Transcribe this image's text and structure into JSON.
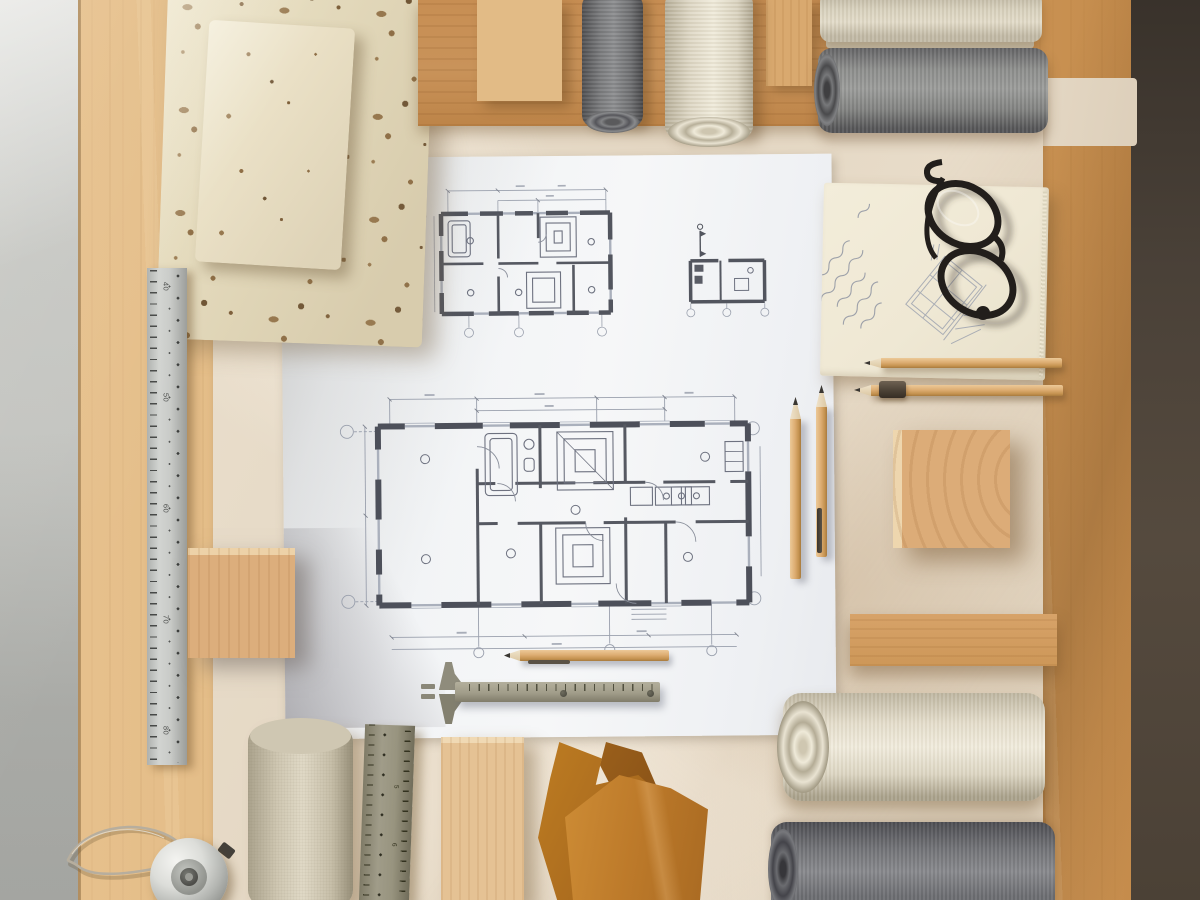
{
  "scene": {
    "type": "photograph",
    "subject": "Architectural flat lay: house floor-plan drawings on a wooden desk surrounded by travertine stone samples, oak wood blocks, rolled fabric swatches, leather pieces, rulers, a caliper, pencils, a notebook with sketches and folded glasses"
  },
  "palette": {
    "concrete": "#c6c7c3",
    "wood_light": "#e2bb85",
    "wood_orange": "#c58c4c",
    "dark_edge": "#4a4138",
    "kraft": "#e6d9c7",
    "paper_white": "#f3f4f6",
    "plan_wall": "#4d505a",
    "plan_line": "#9aa0ad",
    "travertine": "#e4dabc",
    "fabric_gray": "#8b8b89",
    "fabric_cream": "#e9e3d3",
    "fabric_beige": "#d8d1bd",
    "notebook": "#efe8d4",
    "glasses_black": "#211d1a",
    "pencil_wood": "#ddad72",
    "leather": "#bd7a2a",
    "chrome": "#d9dad6",
    "tool_olive": "#a19d8a",
    "ruler_silver": "#c9cbc8"
  },
  "rulers": {
    "left_ruler_labels": [
      "40",
      "50",
      "60",
      "70",
      "80"
    ],
    "bottom_ruler_labels": [
      "5",
      "6"
    ]
  }
}
